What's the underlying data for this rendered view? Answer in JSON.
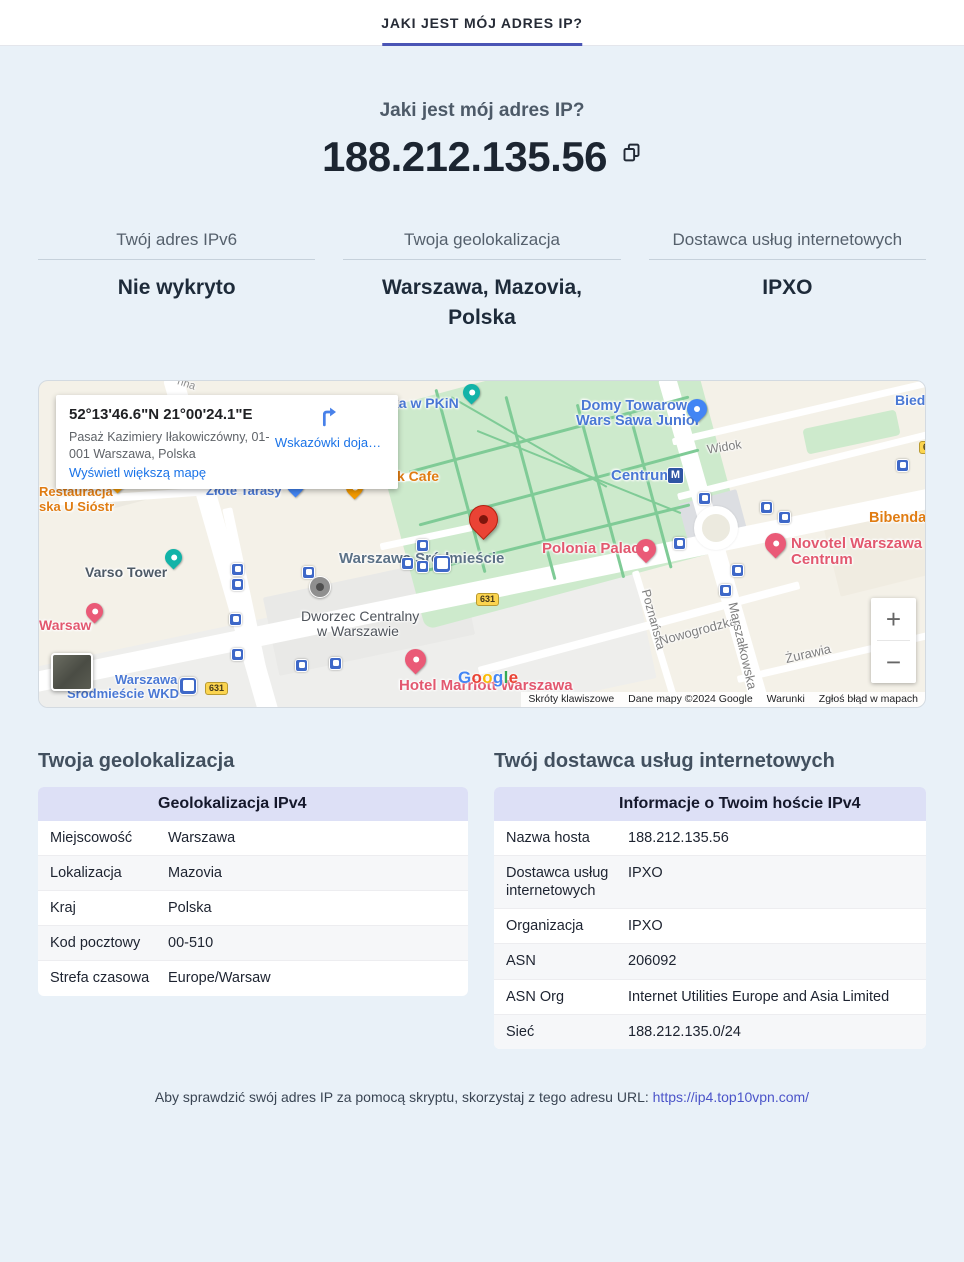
{
  "theme": {
    "accent": "#4a55b5",
    "page_bg": "#e9f1f8",
    "table_header_bg": "#dde0f6",
    "link": "#4b54c9",
    "map_link": "#1a73e8"
  },
  "tab": {
    "label": "JAKI JEST MÓJ ADRES IP?"
  },
  "hero": {
    "title": "Jaki jest mój adres IP?",
    "ip": "188.212.135.56"
  },
  "summary": [
    {
      "label": "Twój adres IPv6",
      "value": "Nie wykryto"
    },
    {
      "label": "Twoja geolokalizacja",
      "value": "Warszawa, Mazovia, Polska"
    },
    {
      "label": "Dostawca usług internetowych",
      "value": "IPXO"
    }
  ],
  "map": {
    "card": {
      "coords": "52°13'46.6\"N 21°00'24.1\"E",
      "address_line1": "Pasaż Kazimiery Iłakowiczówny, 01-",
      "address_line2": "001 Warszawa, Polska",
      "link": "Wyświetl większą mapę",
      "directions": "Wskazówki doja…"
    },
    "zoom_in": "+",
    "zoom_out": "−",
    "google": [
      {
        "ch": "G",
        "c": "#4285F4"
      },
      {
        "ch": "o",
        "c": "#EA4335"
      },
      {
        "ch": "o",
        "c": "#FBBC05"
      },
      {
        "ch": "g",
        "c": "#4285F4"
      },
      {
        "ch": "l",
        "c": "#34A853"
      },
      {
        "ch": "e",
        "c": "#EA4335"
      }
    ],
    "attribution": [
      {
        "text": "Skróty klawiszowe",
        "i": true
      },
      {
        "text": "Dane mapy ©2024 Google",
        "i": false
      },
      {
        "text": "Warunki",
        "i": true
      },
      {
        "text": "Zgłoś błąd w mapach",
        "i": true
      }
    ],
    "elements": [
      {
        "t": "rect",
        "n": "district-block",
        "x": -30,
        "y": 225,
        "w": 640,
        "h": 140,
        "r": -12,
        "c": "#eeeeec"
      },
      {
        "t": "rect",
        "n": "station-block",
        "x": 230,
        "y": 195,
        "w": 200,
        "h": 80,
        "r": -12,
        "c": "#e9e9e7"
      },
      {
        "t": "rect",
        "n": "building-block",
        "x": 60,
        "y": 40,
        "w": 150,
        "h": 70,
        "r": -15,
        "c": "#ece9e0"
      },
      {
        "t": "rect",
        "n": "building-block",
        "x": 505,
        "y": 28,
        "w": 110,
        "h": 55,
        "r": -15,
        "c": "#ece7db"
      },
      {
        "t": "rect",
        "n": "building-block",
        "x": 790,
        "y": 120,
        "w": 140,
        "h": 80,
        "r": -14,
        "c": "#f0ece1"
      },
      {
        "t": "rect",
        "n": "park-area",
        "x": 352,
        "y": -15,
        "w": 330,
        "h": 225,
        "r": -15,
        "c": "#cdeacc",
        "rad": 10
      },
      {
        "t": "rect",
        "n": "green-area",
        "x": 765,
        "y": 38,
        "w": 95,
        "h": 26,
        "r": -12,
        "c": "#cdeacc",
        "rad": 4
      },
      {
        "t": "rect",
        "n": "rotunda-block",
        "x": 645,
        "y": 115,
        "w": 60,
        "h": 52,
        "r": -15,
        "c": "#dcdee2"
      },
      {
        "t": "rect",
        "n": "road-jerozolimskie",
        "x": -20,
        "y": 198,
        "w": 940,
        "h": 20,
        "r": -11.6,
        "c": "#ffffff",
        "rad": 3
      },
      {
        "t": "rect",
        "n": "road-marszalkowska",
        "x": 667,
        "y": -10,
        "w": 18,
        "h": 350,
        "r": -16,
        "c": "#ffffff",
        "rad": 3
      },
      {
        "t": "rect",
        "n": "road-jana-pawla",
        "x": 172,
        "y": -10,
        "w": 20,
        "h": 350,
        "r": -16,
        "c": "#ffffff",
        "rad": 3
      },
      {
        "t": "rect",
        "n": "road-widok",
        "x": 635,
        "y": 81,
        "w": 260,
        "h": 7,
        "r": -14,
        "c": "#ffffff"
      },
      {
        "t": "rect",
        "n": "road-top-right",
        "x": 630,
        "y": 26,
        "w": 280,
        "h": 7,
        "r": -13,
        "c": "#ffffff"
      },
      {
        "t": "rect",
        "n": "road-nowogrodzka",
        "x": 434,
        "y": 243,
        "w": 332,
        "h": 8,
        "r": -15,
        "c": "#ffffff"
      },
      {
        "t": "rect",
        "n": "road-zurawia",
        "x": 696,
        "y": 273,
        "w": 196,
        "h": 7,
        "r": -13,
        "c": "#ffffff"
      },
      {
        "t": "rect",
        "n": "road-poznanska",
        "x": 614,
        "y": 187,
        "w": 7,
        "h": 146,
        "r": -17,
        "c": "#ffffff"
      },
      {
        "t": "rect",
        "n": "road-emilii-plater",
        "x": 205,
        "y": 125,
        "w": 10,
        "h": 210,
        "r": -12,
        "c": "#ffffff"
      },
      {
        "t": "rect",
        "n": "road-zlota",
        "x": 20,
        "y": 104,
        "w": 360,
        "h": 8,
        "r": -4,
        "c": "#ffffff"
      },
      {
        "t": "rect",
        "n": "road-side",
        "x": 340,
        "y": 150,
        "w": 120,
        "h": 7,
        "r": -12,
        "c": "#ffffff"
      },
      {
        "t": "round",
        "n": "roundabout",
        "x": 655,
        "y": 125
      },
      {
        "t": "rect",
        "n": "park-path",
        "x": 365,
        "y": 52,
        "w": 290,
        "h": 3,
        "r": -15,
        "c": "#7fcb96"
      },
      {
        "t": "rect",
        "n": "park-path",
        "x": 375,
        "y": 105,
        "w": 290,
        "h": 3,
        "r": -15,
        "c": "#7fcb96"
      },
      {
        "t": "rect",
        "n": "park-path",
        "x": 385,
        "y": 155,
        "w": 270,
        "h": 3,
        "r": -14,
        "c": "#7fcb96"
      },
      {
        "t": "rect",
        "n": "park-path",
        "x": 420,
        "y": 5,
        "w": 3,
        "h": 190,
        "r": -15,
        "c": "#7fcb96"
      },
      {
        "t": "rect",
        "n": "park-path",
        "x": 490,
        "y": 12,
        "w": 3,
        "h": 190,
        "r": -15,
        "c": "#7fcb96"
      },
      {
        "t": "rect",
        "n": "park-path",
        "x": 560,
        "y": 20,
        "w": 3,
        "h": 180,
        "r": -15,
        "c": "#7fcb96"
      },
      {
        "t": "rect",
        "n": "park-path",
        "x": 610,
        "y": 30,
        "w": 3,
        "h": 160,
        "r": -15,
        "c": "#7fcb96"
      },
      {
        "t": "rect",
        "n": "park-path",
        "x": 430,
        "y": 90,
        "w": 220,
        "h": 2,
        "r": 22,
        "c": "#7fcb96"
      },
      {
        "t": "rect",
        "n": "park-path",
        "x": 400,
        "y": 60,
        "w": 180,
        "h": 2,
        "r": 30,
        "c": "#7fcb96"
      },
      {
        "t": "label",
        "n": "street-label-sienna",
        "text": "nna",
        "x": 138,
        "y": -2,
        "fs": 11,
        "col": "#8d8d8d",
        "r": 18
      },
      {
        "t": "label",
        "n": "poi-label-restauracja",
        "text": "Restauracja",
        "x": 0,
        "y": 104,
        "fs": 13,
        "col": "#e07c12",
        "b": 1,
        "i": true
      },
      {
        "t": "label",
        "n": "poi-label-restauracja2",
        "text": "ska U Sióstr",
        "x": 0,
        "y": 119,
        "fs": 13,
        "col": "#e07c12",
        "b": 1,
        "i": true
      },
      {
        "t": "pin",
        "n": "restaurant-pin",
        "x": 70,
        "y": 92,
        "c": "#f29900",
        "i": true
      },
      {
        "t": "label",
        "n": "poi-label-zlote-tarasy",
        "text": "Złote Tarasy",
        "x": 167,
        "y": 103,
        "fs": 13,
        "col": "#4a78d4",
        "b": 1,
        "i": true
      },
      {
        "t": "pin",
        "n": "mall-pin",
        "x": 248,
        "y": 96,
        "c": "#4285f4",
        "i": true
      },
      {
        "t": "pin",
        "n": "restaurant-pin",
        "x": 307,
        "y": 98,
        "c": "#f29900",
        "i": true
      },
      {
        "t": "label",
        "n": "poi-label-cafe",
        "text": "k Cafe",
        "x": 358,
        "y": 88,
        "fs": 14,
        "col": "#e07c12",
        "b": 1,
        "i": true
      },
      {
        "t": "label",
        "n": "poi-label-pkin",
        "text": "ka w PKiN",
        "x": 352,
        "y": 15,
        "fs": 14,
        "col": "#4a78d4",
        "b": 1,
        "i": true
      },
      {
        "t": "pin",
        "n": "attraction-pin",
        "x": 424,
        "y": 3,
        "c": "#12b3a8",
        "i": true
      },
      {
        "t": "label",
        "n": "poi-label-varso",
        "text": "Varso Tower",
        "x": 46,
        "y": 184,
        "fs": 14,
        "col": "#4e5a66",
        "b": 1,
        "i": true
      },
      {
        "t": "pin",
        "n": "camera-pin",
        "x": 126,
        "y": 168,
        "c": "#12b3a8",
        "i": true
      },
      {
        "t": "label",
        "n": "poi-label-warsaw-hotel",
        "text": "Warsaw",
        "x": 0,
        "y": 237,
        "fs": 14,
        "col": "#e2586f",
        "b": 1,
        "i": true
      },
      {
        "t": "pin",
        "n": "hotel-pin",
        "x": 47,
        "y": 222,
        "c": "#ea5a77",
        "i": true
      },
      {
        "t": "label",
        "n": "station-label-wkd1",
        "text": "Warszawa",
        "x": 76,
        "y": 292,
        "fs": 13,
        "col": "#4a78d4",
        "b": 1,
        "i": true
      },
      {
        "t": "label",
        "n": "station-label-wkd2",
        "text": "Śródmieście WKD",
        "x": 28,
        "y": 306,
        "fs": 13,
        "col": "#4a78d4",
        "b": 1,
        "i": true
      },
      {
        "t": "bigtransit",
        "n": "train-station-icon",
        "x": 140,
        "y": 296,
        "i": true
      },
      {
        "t": "shield",
        "n": "road-shield-631",
        "text": "631",
        "x": 166,
        "y": 301
      },
      {
        "t": "thumb",
        "n": "satellite-toggle",
        "x": 12,
        "y": 272,
        "i": true
      },
      {
        "t": "circle",
        "n": "dworzec-marker",
        "x": 270,
        "y": 195,
        "i": true
      },
      {
        "t": "label",
        "n": "poi-label-dworzec1",
        "text": "Dworzec Centralny",
        "x": 262,
        "y": 228,
        "fs": 14,
        "col": "#4f545b",
        "i": true
      },
      {
        "t": "label",
        "n": "poi-label-dworzec2",
        "text": "w Warszawie",
        "x": 278,
        "y": 243,
        "fs": 14,
        "col": "#4f545b",
        "i": true
      },
      {
        "t": "label",
        "n": "station-label-srodmiescie",
        "text": "Warszawa Śródmieście",
        "x": 300,
        "y": 170,
        "fs": 15,
        "col": "#5b7186",
        "b": 1,
        "i": true
      },
      {
        "t": "transit",
        "n": "transit-icon",
        "x": 362,
        "y": 176,
        "i": true
      },
      {
        "t": "transit",
        "n": "transit-icon",
        "x": 377,
        "y": 179,
        "i": true
      },
      {
        "t": "bigtransit",
        "n": "train-station-icon",
        "x": 394,
        "y": 174,
        "i": true
      },
      {
        "t": "label",
        "n": "poi-label-centrum",
        "text": "Centrum",
        "x": 572,
        "y": 87,
        "fs": 15,
        "col": "#4a78d4",
        "b": 1,
        "i": true
      },
      {
        "t": "metro",
        "n": "metro-icon",
        "text": "M",
        "x": 628,
        "y": 86,
        "i": true
      },
      {
        "t": "label",
        "n": "poi-label-wars-sawa1",
        "text": "Domy Towarowe",
        "x": 542,
        "y": 18,
        "fs": 14.5,
        "col": "#4a78d4",
        "b": 1,
        "i": true
      },
      {
        "t": "label",
        "n": "poi-label-wars-sawa2",
        "text": "Wars Sawa Junior",
        "x": 537,
        "y": 33,
        "fs": 14.5,
        "col": "#4a78d4",
        "b": 1,
        "i": true
      },
      {
        "t": "pin",
        "n": "shopping-pin",
        "x": 648,
        "y": 18,
        "c": "#4285f4",
        "s": 20,
        "i": true
      },
      {
        "t": "label",
        "n": "street-label-widok",
        "text": "Widok",
        "x": 668,
        "y": 60,
        "fs": 12.5,
        "col": "#7e7e7e",
        "r": -9
      },
      {
        "t": "label",
        "n": "poi-label-biedronka",
        "text": "Biedr",
        "x": 856,
        "y": 12,
        "fs": 14,
        "col": "#4a78d4",
        "b": 1,
        "i": true
      },
      {
        "t": "shield",
        "n": "road-shield-6",
        "text": "6",
        "x": 880,
        "y": 60
      },
      {
        "t": "label",
        "n": "poi-label-bibenda",
        "text": "Bibenda",
        "x": 830,
        "y": 130,
        "fs": 14.5,
        "col": "#e07c12",
        "b": 1,
        "i": true
      },
      {
        "t": "pin",
        "n": "hotel-pin",
        "x": 726,
        "y": 152,
        "c": "#ea5a77",
        "s": 21,
        "i": true
      },
      {
        "t": "label",
        "n": "poi-label-novotel1",
        "text": "Novotel Warszawa",
        "x": 752,
        "y": 155,
        "fs": 15,
        "col": "#e2586f",
        "b": 1,
        "i": true
      },
      {
        "t": "label",
        "n": "poi-label-novotel2",
        "text": "Centrum",
        "x": 752,
        "y": 171,
        "fs": 15,
        "col": "#e2586f",
        "b": 1,
        "i": true
      },
      {
        "t": "label",
        "n": "poi-label-polonia",
        "text": "Polonia Palace",
        "x": 503,
        "y": 160,
        "fs": 15,
        "col": "#e2586f",
        "b": 1,
        "i": true
      },
      {
        "t": "pin",
        "n": "hotel-pin",
        "x": 597,
        "y": 158,
        "c": "#ea5a77",
        "s": 20,
        "i": true
      },
      {
        "t": "redpin",
        "n": "location-pin",
        "x": 430,
        "y": 124,
        "i": true
      },
      {
        "t": "label",
        "n": "street-label-poznanska",
        "text": "Poznańska",
        "x": 583,
        "y": 232,
        "fs": 12.5,
        "col": "#7e7e7e",
        "r": 75
      },
      {
        "t": "label",
        "n": "street-label-nowogrodzka",
        "text": "Nowogrodzka",
        "x": 619,
        "y": 243,
        "fs": 13,
        "col": "#7e7e7e",
        "r": -15
      },
      {
        "t": "label",
        "n": "street-label-marszalkowska",
        "text": "Marszałkowska",
        "x": 659,
        "y": 258,
        "fs": 13,
        "col": "#7e7e7e",
        "r": 77
      },
      {
        "t": "label",
        "n": "street-label-zurawia",
        "text": "Żurawia",
        "x": 746,
        "y": 266,
        "fs": 13,
        "col": "#7e7e7e",
        "r": -13
      },
      {
        "t": "pin",
        "n": "hotel-pin",
        "x": 366,
        "y": 268,
        "c": "#ea5a77",
        "s": 21,
        "i": true
      },
      {
        "t": "label",
        "n": "poi-label-marriott",
        "text": "Hotel Marriott Warszawa",
        "x": 360,
        "y": 297,
        "fs": 15,
        "col": "#e2586f",
        "b": 1,
        "i": true
      },
      {
        "t": "transit",
        "n": "transit-icon",
        "x": 192,
        "y": 182,
        "i": true
      },
      {
        "t": "transit",
        "n": "transit-icon",
        "x": 192,
        "y": 197,
        "i": true
      },
      {
        "t": "transit",
        "n": "transit-icon",
        "x": 263,
        "y": 185,
        "i": true
      },
      {
        "t": "transit",
        "n": "transit-icon",
        "x": 190,
        "y": 232,
        "i": true
      },
      {
        "t": "transit",
        "n": "transit-icon",
        "x": 192,
        "y": 267,
        "i": true
      },
      {
        "t": "transit",
        "n": "transit-icon",
        "x": 256,
        "y": 278,
        "i": true
      },
      {
        "t": "transit",
        "n": "transit-icon",
        "x": 290,
        "y": 276,
        "i": true
      },
      {
        "t": "transit",
        "n": "transit-icon",
        "x": 377,
        "y": 158,
        "i": true
      },
      {
        "t": "transit",
        "n": "transit-icon",
        "x": 659,
        "y": 111,
        "i": true
      },
      {
        "t": "transit",
        "n": "transit-icon",
        "x": 721,
        "y": 120,
        "i": true
      },
      {
        "t": "transit",
        "n": "transit-icon",
        "x": 739,
        "y": 130,
        "i": true
      },
      {
        "t": "transit",
        "n": "transit-icon",
        "x": 634,
        "y": 156,
        "i": true
      },
      {
        "t": "transit",
        "n": "transit-icon",
        "x": 692,
        "y": 183,
        "i": true
      },
      {
        "t": "transit",
        "n": "transit-icon",
        "x": 680,
        "y": 203,
        "i": true
      },
      {
        "t": "transit",
        "n": "transit-icon",
        "x": 857,
        "y": 78,
        "i": true
      },
      {
        "t": "shield",
        "n": "road-shield-631",
        "text": "631",
        "x": 437,
        "y": 212
      }
    ]
  },
  "geo_table": {
    "title": "Twoja geolokalizacja",
    "header": "Geolokalizacja IPv4",
    "rows": [
      [
        "Miejscowość",
        "Warszawa"
      ],
      [
        "Lokalizacja",
        "Mazovia"
      ],
      [
        "Kraj",
        "Polska"
      ],
      [
        "Kod pocztowy",
        "00-510"
      ],
      [
        "Strefa czasowa",
        "Europe/Warsaw"
      ]
    ]
  },
  "isp_table": {
    "title": "Twój dostawca usług internetowych",
    "header": "Informacje o Twoim hoście IPv4",
    "rows": [
      [
        "Nazwa hosta",
        "188.212.135.56"
      ],
      [
        "Dostawca usług internetowych",
        "IPXO"
      ],
      [
        "Organizacja",
        "IPXO"
      ],
      [
        "ASN",
        "206092"
      ],
      [
        "ASN Org",
        "Internet Utilities Europe and Asia Limited"
      ],
      [
        "Sieć",
        "188.212.135.0/24"
      ]
    ]
  },
  "footer": {
    "text": "Aby sprawdzić swój adres IP za pomocą skryptu, skorzystaj z tego adresu URL:",
    "link": "https://ip4.top10vpn.com/"
  }
}
